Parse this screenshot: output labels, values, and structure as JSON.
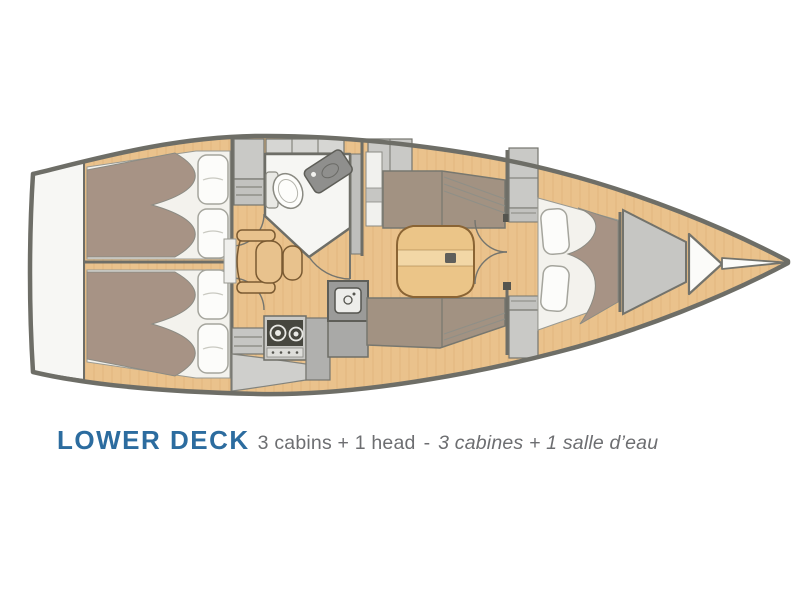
{
  "caption": {
    "title": "LOWER DECK",
    "cabins_en": "3 cabins + 1 head",
    "separator": "-",
    "cabins_fr": "3 cabines + 1 salle d’eau"
  },
  "palette": {
    "title_blue": "#2C6C9F",
    "caption_gray": "#6D6E71",
    "hull_outline": "#6E6E67",
    "deck_wood": "#EAC28C",
    "upholstery_taupe": "#A79385",
    "cabinet_gray": "#CBCBC8",
    "head_floor_white": "#F6F6F3",
    "table_wood": "#EBC588"
  },
  "diagram": {
    "type": "sailboat-lower-deck-floorplan",
    "orientation": "bow-right-stern-left",
    "rooms": [
      "aft cabin port with double berth",
      "aft cabin starboard with double berth",
      "head with toilet and washbasin",
      "salon with table and settees",
      "galley with two-burner stove and sink",
      "forward cabin with double berth",
      "anchor locker",
      "stern platform"
    ],
    "features": [
      "double berths with pillows",
      "nav seat",
      "salon table",
      "cabin doors with swing arcs",
      "bowsprit"
    ]
  }
}
